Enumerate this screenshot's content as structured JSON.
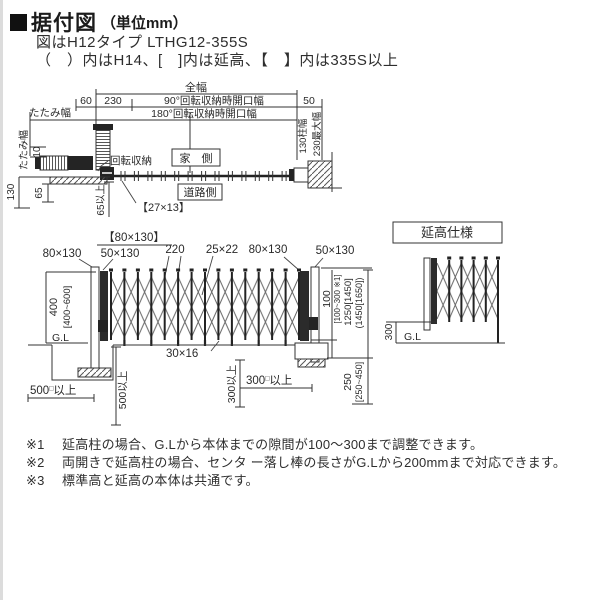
{
  "header": {
    "title": "据付図",
    "unit": "（単位mm）",
    "line1": "図はH12タイプ LTHG12-355S",
    "line2": "（　）内はH14、[　]内は延高、【　】内は335S以上"
  },
  "plan": {
    "zenpuku": "全幅",
    "d60": "60",
    "d230": "230",
    "deg90": "90°回転収納時開口幅",
    "d50": "50",
    "deg180": "180°回転収納時開口幅",
    "tatami_h": "たたみ幅",
    "tatami_v": "たたみ幅",
    "d10": "10",
    "d130": "130",
    "d65": "65",
    "kaiten": "回転収納",
    "house": "家　側",
    "road": "道路側",
    "b27x13": "【27×13】",
    "d65up": "65以上",
    "hashira": "130柱幅",
    "saidai": "230最大幅"
  },
  "elev": {
    "p80x130L": "80×130",
    "pb80x130": "【80×130】",
    "p50x130L": "50×130",
    "d220": "220",
    "d25x22": "25×22",
    "p80x130R": "80×130",
    "p50x130R": "50×130",
    "d400": "400",
    "d400r": "[400~600]",
    "gl": "G.L",
    "d500n": "500",
    "sq": "□",
    "up": "以上",
    "d500v": "500以上",
    "d30x16": "30×16",
    "d300v": "300以上",
    "d300n": "300",
    "d100": "100",
    "d100r": "[100~300 ※1]",
    "d1250": "1250[1450]",
    "d1450": "(1450[1650])",
    "d250": "250",
    "d250r": "[250~450]"
  },
  "encho": {
    "label": "延高仕様",
    "d300": "300",
    "gl": "G.L"
  },
  "notes": [
    {
      "mark": "※1",
      "text": "延高柱の場合、G.Lから本体までの隙間が100～300まで調整できます。"
    },
    {
      "mark": "※2",
      "text": "両開きで延高柱の場合、センタ ー落し棒の長さがG.Lから200mmまで対応できます。"
    },
    {
      "mark": "※3",
      "text": "標準高と延高の本体は共通です。"
    }
  ]
}
